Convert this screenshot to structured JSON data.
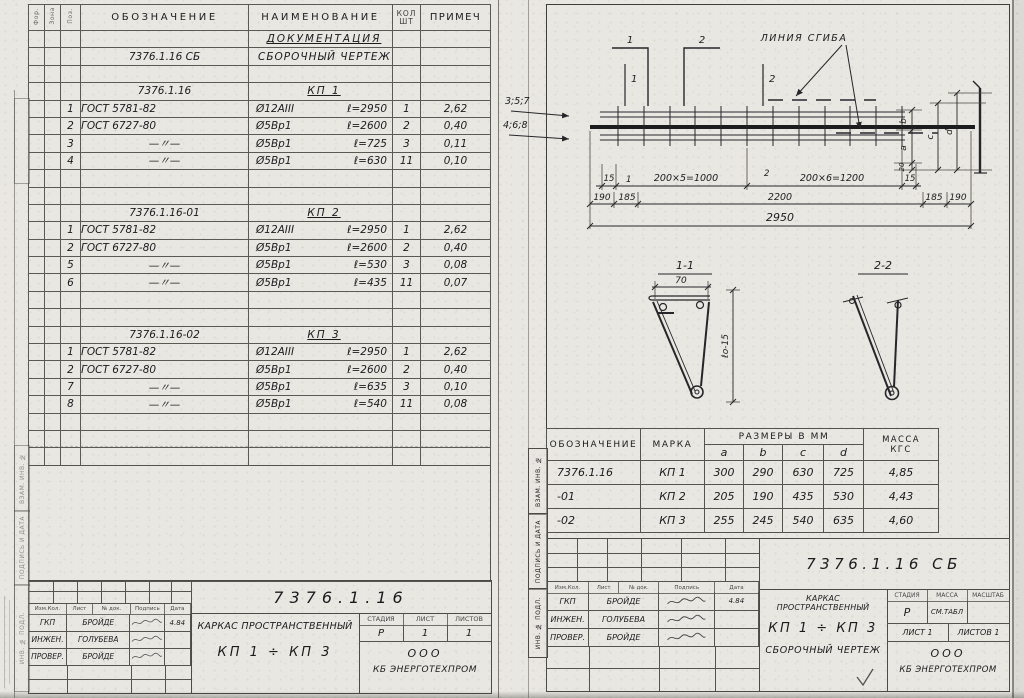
{
  "left_sheet": {
    "spec": {
      "col_format": "Фор.",
      "col_zone": "Зона",
      "col_pos": "Поз.",
      "h_designation": "ОБОЗНАЧЕНИЕ",
      "h_name": "НАИМЕНОВАНИЕ",
      "h_qty_top": "КОЛ",
      "h_qty_bottom": "ШТ",
      "h_note": "ПРИМЕЧ",
      "rows": [
        {
          "cls": "sec",
          "pos": "",
          "des": "",
          "nm": "ДОКУМЕНТАЦИЯ",
          "len": "",
          "qty": "",
          "note": ""
        },
        {
          "cls": "doc",
          "pos": "",
          "des": "7376.1.16 СБ",
          "nm": "СБОРОЧНЫЙ ЧЕРТЕЖ",
          "len": "",
          "qty": "",
          "note": ""
        },
        {
          "cls": "",
          "pos": "",
          "des": "",
          "nm": "",
          "len": "",
          "qty": "",
          "note": ""
        },
        {
          "cls": "grp",
          "pos": "",
          "des": "7376.1.16",
          "nm": "КП 1",
          "len": "",
          "qty": "",
          "note": ""
        },
        {
          "cls": "",
          "pos": "1",
          "des": "ГОСТ 5781-82",
          "nm": "Ø12АIII",
          "len": "ℓ=2950",
          "qty": "1",
          "note": "2,62"
        },
        {
          "cls": "",
          "pos": "2",
          "des": "ГОСТ 6727-80",
          "nm": "Ø5Вр1",
          "len": "ℓ=2600",
          "qty": "2",
          "note": "0,40"
        },
        {
          "cls": "dit",
          "pos": "3",
          "des": "—〃—",
          "nm": "Ø5Вр1",
          "len": "ℓ=725",
          "qty": "3",
          "note": "0,11"
        },
        {
          "cls": "dit",
          "pos": "4",
          "des": "—〃—",
          "nm": "Ø5Вр1",
          "len": "ℓ=630",
          "qty": "11",
          "note": "0,10"
        },
        {
          "cls": "",
          "pos": "",
          "des": "",
          "nm": "",
          "len": "",
          "qty": "",
          "note": ""
        },
        {
          "cls": "",
          "pos": "",
          "des": "",
          "nm": "",
          "len": "",
          "qty": "",
          "note": ""
        },
        {
          "cls": "grp",
          "pos": "",
          "des": "7376.1.16-01",
          "nm": "КП 2",
          "len": "",
          "qty": "",
          "note": ""
        },
        {
          "cls": "",
          "pos": "1",
          "des": "ГОСТ 5781-82",
          "nm": "Ø12АIII",
          "len": "ℓ=2950",
          "qty": "1",
          "note": "2,62"
        },
        {
          "cls": "",
          "pos": "2",
          "des": "ГОСТ 6727-80",
          "nm": "Ø5Вр1",
          "len": "ℓ=2600",
          "qty": "2",
          "note": "0,40"
        },
        {
          "cls": "dit",
          "pos": "5",
          "des": "—〃—",
          "nm": "Ø5Вр1",
          "len": "ℓ=530",
          "qty": "3",
          "note": "0,08"
        },
        {
          "cls": "dit",
          "pos": "6",
          "des": "—〃—",
          "nm": "Ø5Вр1",
          "len": "ℓ=435",
          "qty": "11",
          "note": "0,07"
        },
        {
          "cls": "",
          "pos": "",
          "des": "",
          "nm": "",
          "len": "",
          "qty": "",
          "note": ""
        },
        {
          "cls": "",
          "pos": "",
          "des": "",
          "nm": "",
          "len": "",
          "qty": "",
          "note": ""
        },
        {
          "cls": "grp",
          "pos": "",
          "des": "7376.1.16-02",
          "nm": "КП 3",
          "len": "",
          "qty": "",
          "note": ""
        },
        {
          "cls": "",
          "pos": "1",
          "des": "ГОСТ 5781-82",
          "nm": "Ø12АIII",
          "len": "ℓ=2950",
          "qty": "1",
          "note": "2,62"
        },
        {
          "cls": "",
          "pos": "2",
          "des": "ГОСТ 6727-80",
          "nm": "Ø5Вр1",
          "len": "ℓ=2600",
          "qty": "2",
          "note": "0,40"
        },
        {
          "cls": "dit",
          "pos": "7",
          "des": "—〃—",
          "nm": "Ø5Вр1",
          "len": "ℓ=635",
          "qty": "3",
          "note": "0,10"
        },
        {
          "cls": "dit",
          "pos": "8",
          "des": "—〃—",
          "nm": "Ø5Вр1",
          "len": "ℓ=540",
          "qty": "11",
          "note": "0,08"
        },
        {
          "cls": "",
          "pos": "",
          "des": "",
          "nm": "",
          "len": "",
          "qty": "",
          "note": ""
        },
        {
          "cls": "",
          "pos": "",
          "des": "",
          "nm": "",
          "len": "",
          "qty": "",
          "note": ""
        },
        {
          "cls": "",
          "pos": "",
          "des": "",
          "nm": "",
          "len": "",
          "qty": "",
          "note": ""
        }
      ]
    },
    "title_block": {
      "doc_number": "7376.1.16",
      "product_title": "КАРКАС ПРОСТРАНСТВЕННЫЙ",
      "product_marks": "КП 1 ÷ КП 3",
      "h_izm": "Изм.Кол.",
      "h_list": "Лист",
      "h_doc": "№ док.",
      "h_sign": "Подпись",
      "h_date": "Дата",
      "approvals": [
        {
          "role": "ГКП",
          "name": "БРОЙДЕ",
          "date": "4.84"
        },
        {
          "role": "ИНЖЕН.",
          "name": "ГОЛУБЕВА",
          "date": ""
        },
        {
          "role": "ПРОВЕР.",
          "name": "БРОЙДЕ",
          "date": ""
        }
      ],
      "h_stage": "СТАДИЯ",
      "h_sheet": "ЛИСТ",
      "h_sheets": "ЛИСТОВ",
      "stage": "Р",
      "sheet": "1",
      "sheets": "1",
      "org_line1": "ООО",
      "org_line2": "КБ ЭНЕРГОТЕХПРОМ"
    }
  },
  "side_stamps": [
    "ВЗАМ. ИНВ. №",
    "ПОДПИСЬ И ДАТА",
    "ИНВ. № ПОДЛ."
  ],
  "right_sheet": {
    "drawing": {
      "cut_label_1": "1",
      "cut_label_2": "2",
      "fold_line_label": "ЛИНИЯ СГИБА",
      "wires_top_label": "3;5;7",
      "wires_bottom_label": "4;6;8",
      "dim_15_left": "15",
      "dim_wire1": "1",
      "dim_span1": "200×5=1000",
      "dim_wire2": "2",
      "dim_span2": "200×6=1200",
      "dim_15_right": "15",
      "dim_190_left": "190",
      "dim_185_left": "185",
      "dim_2200": "2200",
      "dim_185_right": "185",
      "dim_190_right": "190",
      "dim_total": "2950",
      "detail_dim_b": "b",
      "detail_dim_a": "a",
      "detail_dim_20": "20",
      "detail_dim_c": "c",
      "detail_dim_d": "d",
      "section1_label": "1-1",
      "section1_dim_width": "70",
      "section1_dim_height": "ℓо-15",
      "section2_label": "2-2"
    },
    "size_table": {
      "h_designation": "ОБОЗНАЧЕНИЕ",
      "h_mark": "МАРКА",
      "h_sizes": "РАЗМЕРЫ В ММ",
      "h_a": "a",
      "h_b": "b",
      "h_c": "c",
      "h_d": "d",
      "h_mass_top": "МАССА",
      "h_mass_bottom": "КГС",
      "rows": [
        {
          "designation": "7376.1.16",
          "mark": "КП 1",
          "a": "300",
          "b": "290",
          "c": "630",
          "d": "725",
          "mass": "4,85"
        },
        {
          "designation": "-01",
          "mark": "КП 2",
          "a": "205",
          "b": "190",
          "c": "435",
          "d": "530",
          "mass": "4,43"
        },
        {
          "designation": "-02",
          "mark": "КП 3",
          "a": "255",
          "b": "245",
          "c": "540",
          "d": "635",
          "mass": "4,60"
        }
      ]
    },
    "title_block": {
      "doc_number": "7376.1.16 СБ",
      "product_title": "КАРКАС ПРОСТРАНСТВЕННЫЙ",
      "product_marks": "КП 1 ÷ КП 3",
      "doc_type": "СБОРОЧНЫЙ ЧЕРТЕЖ",
      "h_izm": "Изм.Кол.",
      "h_list": "Лист",
      "h_doc": "№ док.",
      "h_sign": "Подпись",
      "h_date": "Дата",
      "approvals": [
        {
          "role": "ГКП",
          "name": "БРОЙДЕ",
          "date": "4.84"
        },
        {
          "role": "ИНЖЕН.",
          "name": "ГОЛУБЕВА",
          "date": ""
        },
        {
          "role": "ПРОВЕР.",
          "name": "БРОЙДЕ",
          "date": ""
        }
      ],
      "h_stage": "СТАДИЯ",
      "h_mass": "МАССА",
      "h_scale": "МАСШТАБ",
      "stage": "Р",
      "mass": "СМ.ТАБЛ",
      "scale": "",
      "sheet": "ЛИСТ 1",
      "sheets": "ЛИСТОВ 1",
      "org_line1": "ООО",
      "org_line2": "КБ ЭНЕРГОТЕХПРОМ"
    }
  }
}
